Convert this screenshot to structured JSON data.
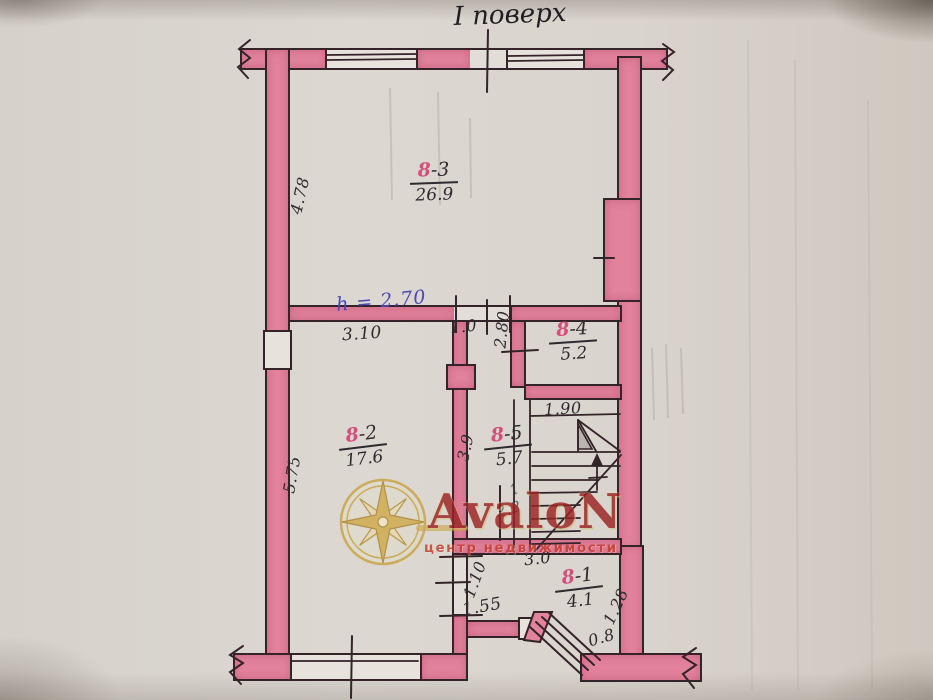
{
  "title": "І поверх",
  "rooms": {
    "r83": {
      "block": "8",
      "num": "-3",
      "area": "26.9"
    },
    "r84": {
      "block": "8",
      "num": "-4",
      "area": "5.2"
    },
    "r82": {
      "block": "8",
      "num": "-2",
      "area": "17.6"
    },
    "r85": {
      "block": "8",
      "num": "-5",
      "area": "5.7"
    },
    "r81": {
      "block": "8",
      "num": "-1",
      "area": "4.1"
    }
  },
  "dimensions": {
    "left_wall_upper": "4.78",
    "left_wall_lower": "5.75",
    "partition_width": "3.10",
    "door_opening": "1.0",
    "wall_depth_284": "2.80",
    "room84_width": "1.90",
    "corridor_length": "3.9",
    "room81_width": "3.0",
    "door_110": "1.10",
    "opening_155": "1.55",
    "entry_door": "0.8",
    "right_wall_lower": "1.28",
    "stair_note_upper": "1",
    "stair_note": "2.2"
  },
  "notes": {
    "ceiling_height": "h = 2.70"
  },
  "watermark": {
    "brand": "AvaloN",
    "tagline": "центр недвижимости"
  },
  "colors": {
    "wall_fill": "#e2829b",
    "wall_outline": "#342329",
    "ink": "#2d2a30",
    "room_accent": "#d34f7d",
    "note_ink": "#4a49b5",
    "watermark_red": "#9b2224",
    "watermark_gold": "#c9a23f"
  }
}
